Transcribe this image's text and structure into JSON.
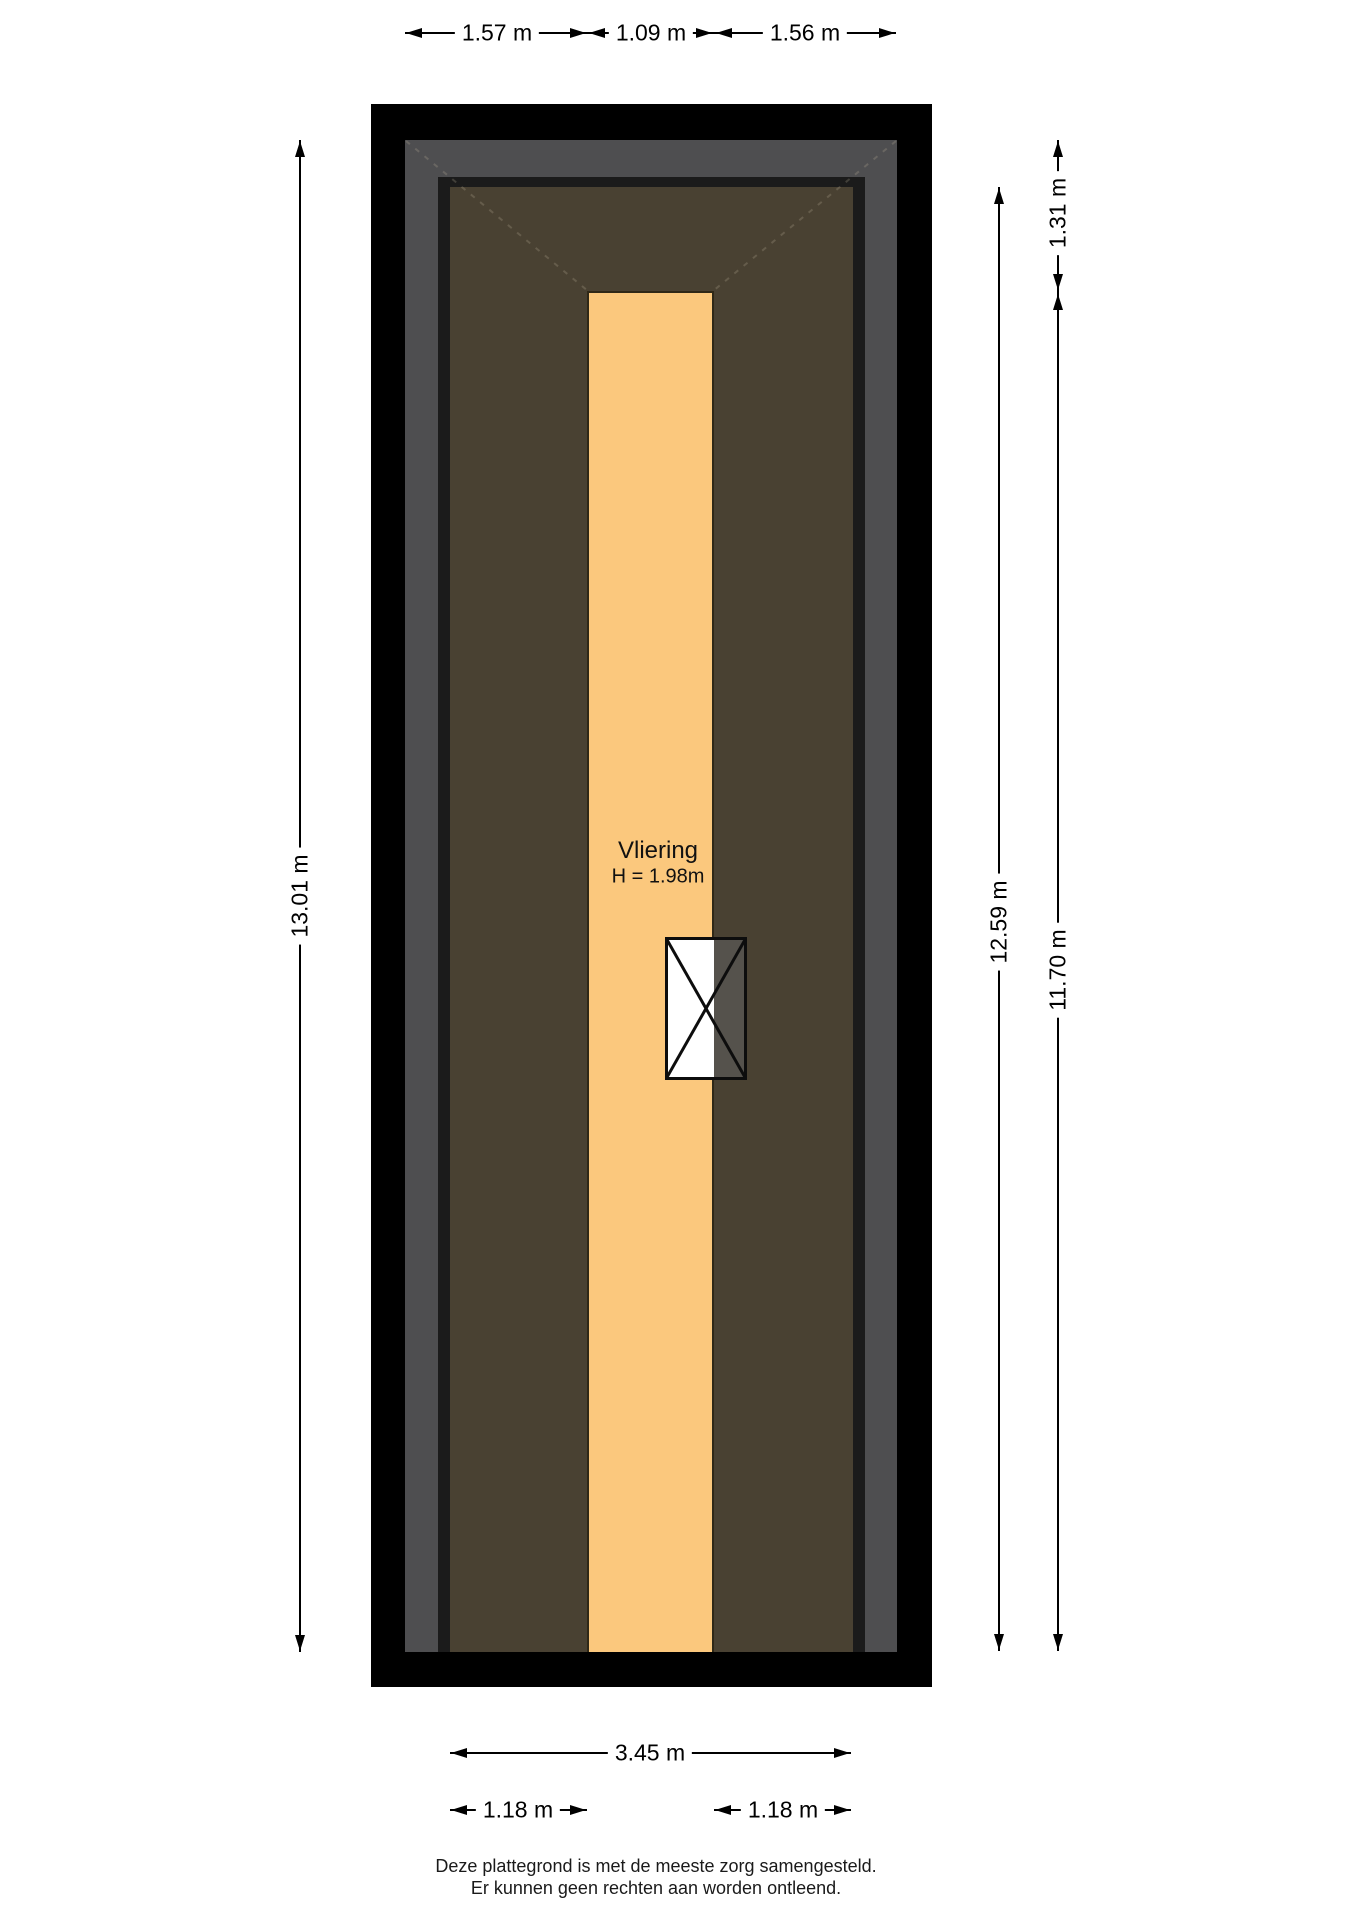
{
  "room": {
    "name": "Vliering",
    "height_label": "H = 1.98m"
  },
  "dimensions": {
    "top": [
      {
        "label": "1.57 m"
      },
      {
        "label": "1.09 m"
      },
      {
        "label": "1.56 m"
      }
    ],
    "left_total": {
      "label": "13.01 m"
    },
    "right_inner": {
      "label": "12.59 m"
    },
    "right_outer_top": {
      "label": "1.31 m"
    },
    "right_outer_bottom": {
      "label": "11.70 m"
    },
    "bottom_total": {
      "label": "3.45 m"
    },
    "bottom_left": {
      "label": "1.18 m"
    },
    "bottom_right": {
      "label": "1.18 m"
    }
  },
  "footer": {
    "line1": "Deze plattegrond is met de meeste zorg samengesteld.",
    "line2": "Er kunnen geen rechten aan worden ontleend."
  },
  "colors": {
    "wall": "#000000",
    "roof_band": "#4e4e50",
    "inner_wall_line": "#1b1b1b",
    "attic_floor": "#494132",
    "vliering_floor": "#fbc87d",
    "hatch_white": "#ffffff",
    "hatch_shade": "#55524c",
    "dimension_ink": "#000000"
  }
}
